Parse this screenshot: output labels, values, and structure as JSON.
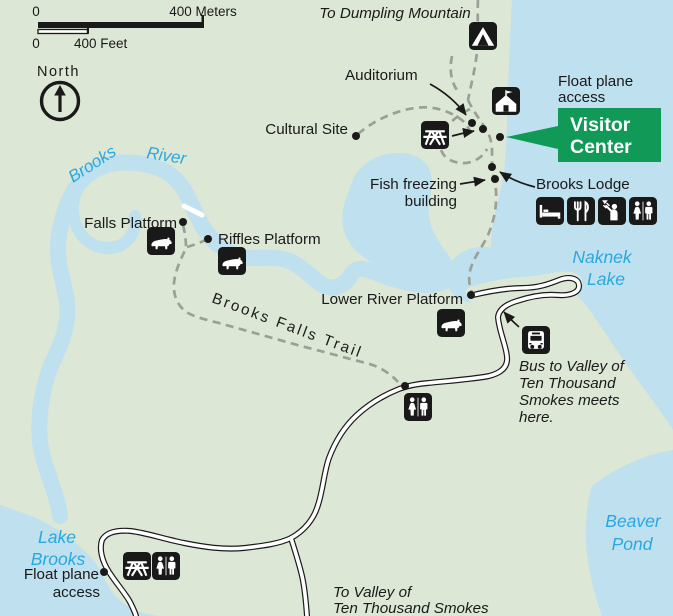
{
  "colors": {
    "land": "#dde7d5",
    "water": "#bfe0ef",
    "water-label": "#29a8e0",
    "green": "#119a57",
    "ink": "#1a1a1a",
    "trail": "#9aa096",
    "road-fill": "#ffffff"
  },
  "scale_bar": {
    "meters_start": "0",
    "meters_label": "400 Meters",
    "feet_start": "0",
    "feet_label": "400 Feet"
  },
  "compass_label": "North",
  "labels": {
    "to_dumpling_mountain": "To Dumpling Mountain",
    "auditorium": "Auditorium",
    "cultural_site": "Cultural Site",
    "float_plane_access_top": {
      "line1": "Float plane",
      "line2": "access"
    },
    "visitor_center": {
      "line1": "Visitor",
      "line2": "Center"
    },
    "fish_freezing": {
      "line1": "Fish freezing",
      "line2": "building"
    },
    "brooks_lodge": "Brooks Lodge",
    "falls_platform": "Falls Platform",
    "riffles_platform": "Riffles Platform",
    "lower_river_platform": "Lower River Platform",
    "brooks_falls_trail": "Brooks Falls Trail",
    "bus_note": {
      "line1": "Bus to Valley of",
      "line2": "Ten Thousand",
      "line3": "Smokes meets",
      "line4": "here."
    },
    "float_plane_access_bottom": {
      "line1": "Float plane",
      "line2": "access"
    },
    "to_valley": {
      "line1": "To Valley of",
      "line2": "Ten Thousand Smokes"
    }
  },
  "water_labels": {
    "brooks": "Brooks",
    "river": "River",
    "naknek": {
      "line1": "Naknek",
      "line2": "Lake"
    },
    "lake_brooks": {
      "line1": "Lake",
      "line2": "Brooks"
    },
    "beaver_pond": {
      "line1": "Beaver",
      "line2": "Pond"
    }
  },
  "icons": {
    "campground": "campground-tent-icon",
    "ranger_station": "ranger-station-icon",
    "picnic_area": "picnic-table-icon",
    "lodging": "lodging-bed-icon",
    "food_service": "food-service-icon",
    "shower": "shower-icon",
    "restrooms": "restrooms-icon",
    "bear_viewing": "bear-icon",
    "bus_stop": "bus-icon"
  }
}
